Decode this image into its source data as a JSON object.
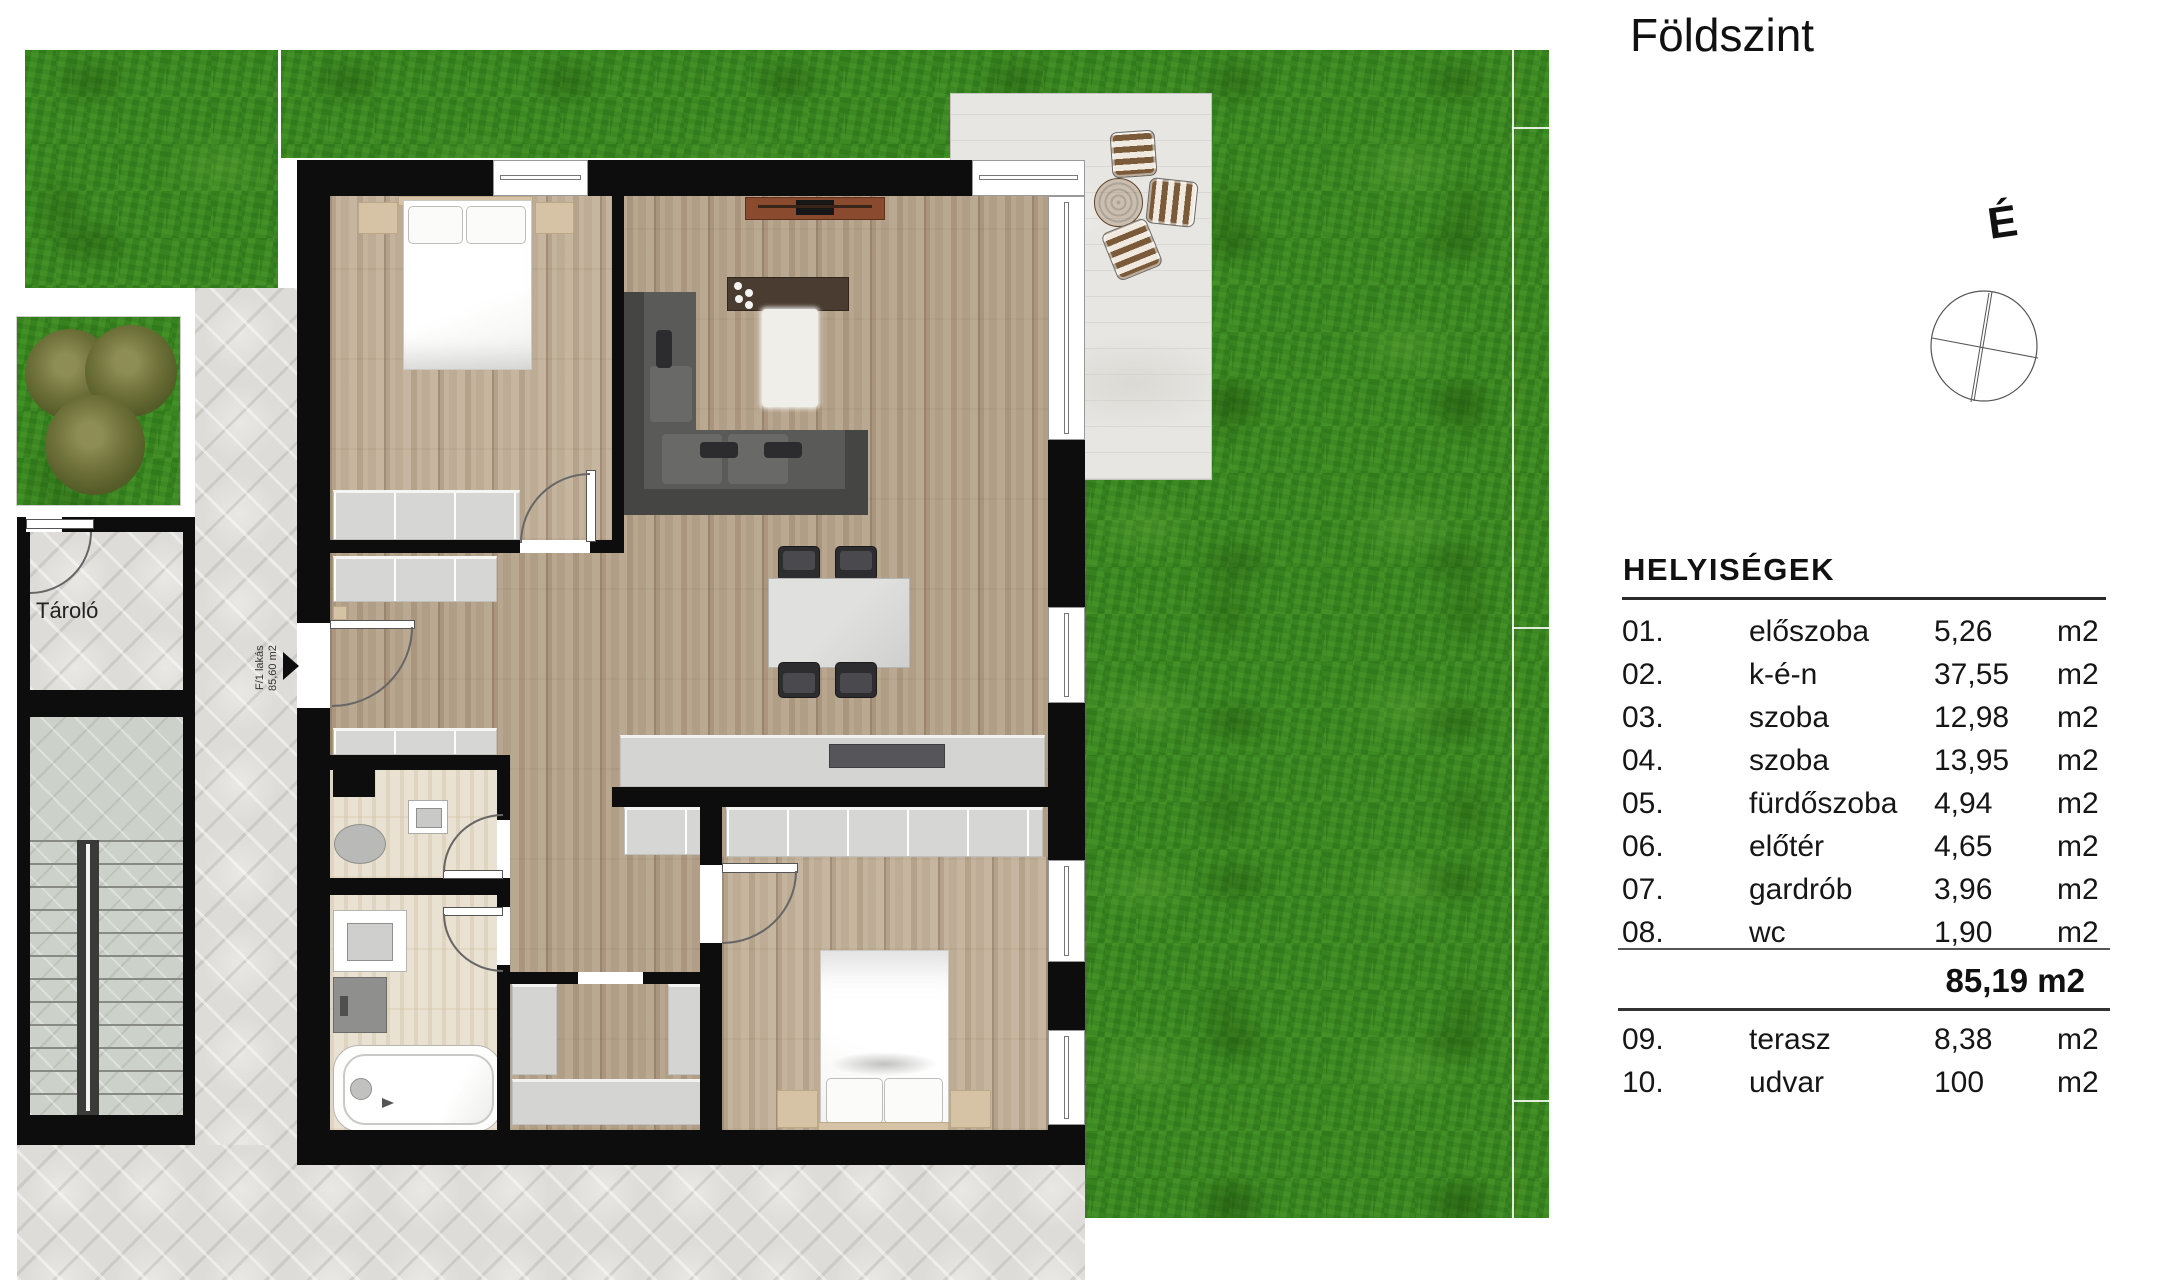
{
  "panel": {
    "title": "Földszint",
    "compass": {
      "label": "É"
    },
    "table": {
      "title": "HELYISÉGEK",
      "rooms": [
        {
          "num": "01.",
          "name": "előszoba",
          "area": "5,26",
          "unit": "m2"
        },
        {
          "num": "02.",
          "name": "k-é-n",
          "area": "37,55",
          "unit": "m2"
        },
        {
          "num": "03.",
          "name": "szoba",
          "area": "12,98",
          "unit": "m2"
        },
        {
          "num": "04.",
          "name": "szoba",
          "area": "13,95",
          "unit": "m2"
        },
        {
          "num": "05.",
          "name": "fürdőszoba",
          "area": "4,94",
          "unit": "m2"
        },
        {
          "num": "06.",
          "name": "előtér",
          "area": "4,65",
          "unit": "m2"
        },
        {
          "num": "07.",
          "name": "gardrób",
          "area": "3,96",
          "unit": "m2"
        },
        {
          "num": "08.",
          "name": "wc",
          "area": "1,90",
          "unit": "m2"
        }
      ],
      "total": "85,19 m2",
      "outdoor": [
        {
          "num": "09.",
          "name": "terasz",
          "area": "8,38",
          "unit": "m2"
        },
        {
          "num": "10.",
          "name": "udvar",
          "area": "100",
          "unit": "m2"
        }
      ]
    }
  },
  "plan": {
    "labels": {
      "storage": "Tároló",
      "apartment_id": "F/1 lakás",
      "apartment_area": "85,60 m2"
    },
    "colors": {
      "grass": "#3a8a21",
      "wall": "#0d0d0d",
      "wood_floor": "#b4a28b",
      "pavement": "#dddcd8",
      "terrace_stone": "#e7e6e2",
      "cabinet_gray": "#d6d6d4",
      "furniture_tan": "#d6c3a5",
      "console_brown": "#8a4a2e"
    }
  }
}
